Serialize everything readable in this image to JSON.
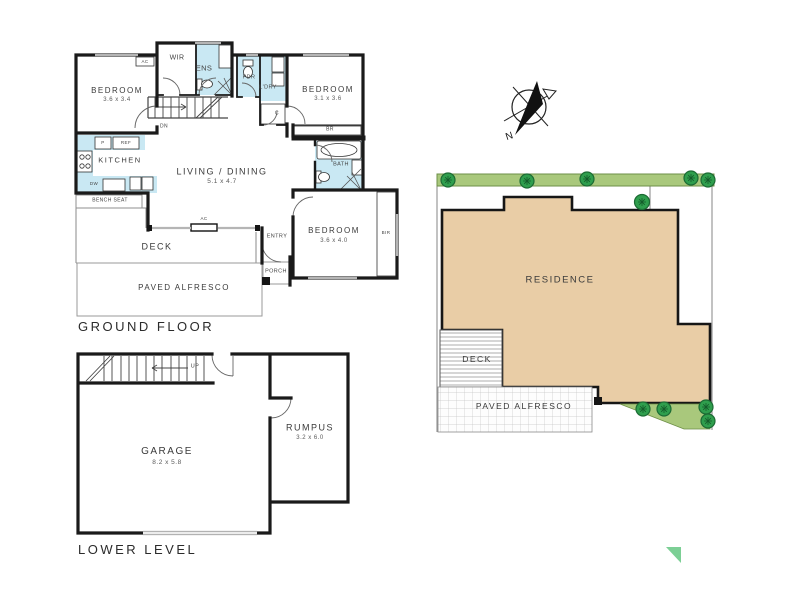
{
  "ground_floor": {
    "title": "GROUND FLOOR",
    "bedroom1_name": "BEDROOM",
    "bedroom1_dims": "3.6 x 3.4",
    "bedroom2_name": "BEDROOM",
    "bedroom2_dims": "3.1 x 3.6",
    "bedroom3_name": "BEDROOM",
    "bedroom3_dims": "3.6 x 4.0",
    "living_name": "LIVING / DINING",
    "living_dims": "5.1 x 4.7",
    "kitchen": "KITCHEN",
    "wir": "WIR",
    "ens": "ENS",
    "pdr": "PDR",
    "ldry": "L'DRY",
    "cupboard": "C",
    "bath": "BATH",
    "br": "BR",
    "bir": "BIR",
    "pantry": "P",
    "fridge": "REF",
    "dishwasher": "DW",
    "ac_wall": "AC",
    "ac_deck": "AC",
    "stairs_down": "DN",
    "bench_seat": "BENCH SEAT",
    "deck": "DECK",
    "entry": "ENTRY",
    "porch": "PORCH",
    "paved_alfresco": "PAVED ALFRESCO"
  },
  "lower_level": {
    "title": "LOWER LEVEL",
    "garage_name": "GARAGE",
    "garage_dims": "8.2 x 5.8",
    "rumpus_name": "RUMPUS",
    "rumpus_dims": "3.2 x 6.0",
    "stairs_up": "UP"
  },
  "site_plan": {
    "residence": "RESIDENCE",
    "deck": "DECK",
    "paved_alfresco": "PAVED ALFRESCO",
    "compass_north": "N"
  },
  "colors": {
    "wall": "#1a1a1a",
    "wet_area": "#c9e8f3",
    "residence_fill": "#e9cda6",
    "garden_strip": "#a9c87c",
    "tree": "#2f9e4d",
    "accent_triangle": "#7ccf95"
  }
}
